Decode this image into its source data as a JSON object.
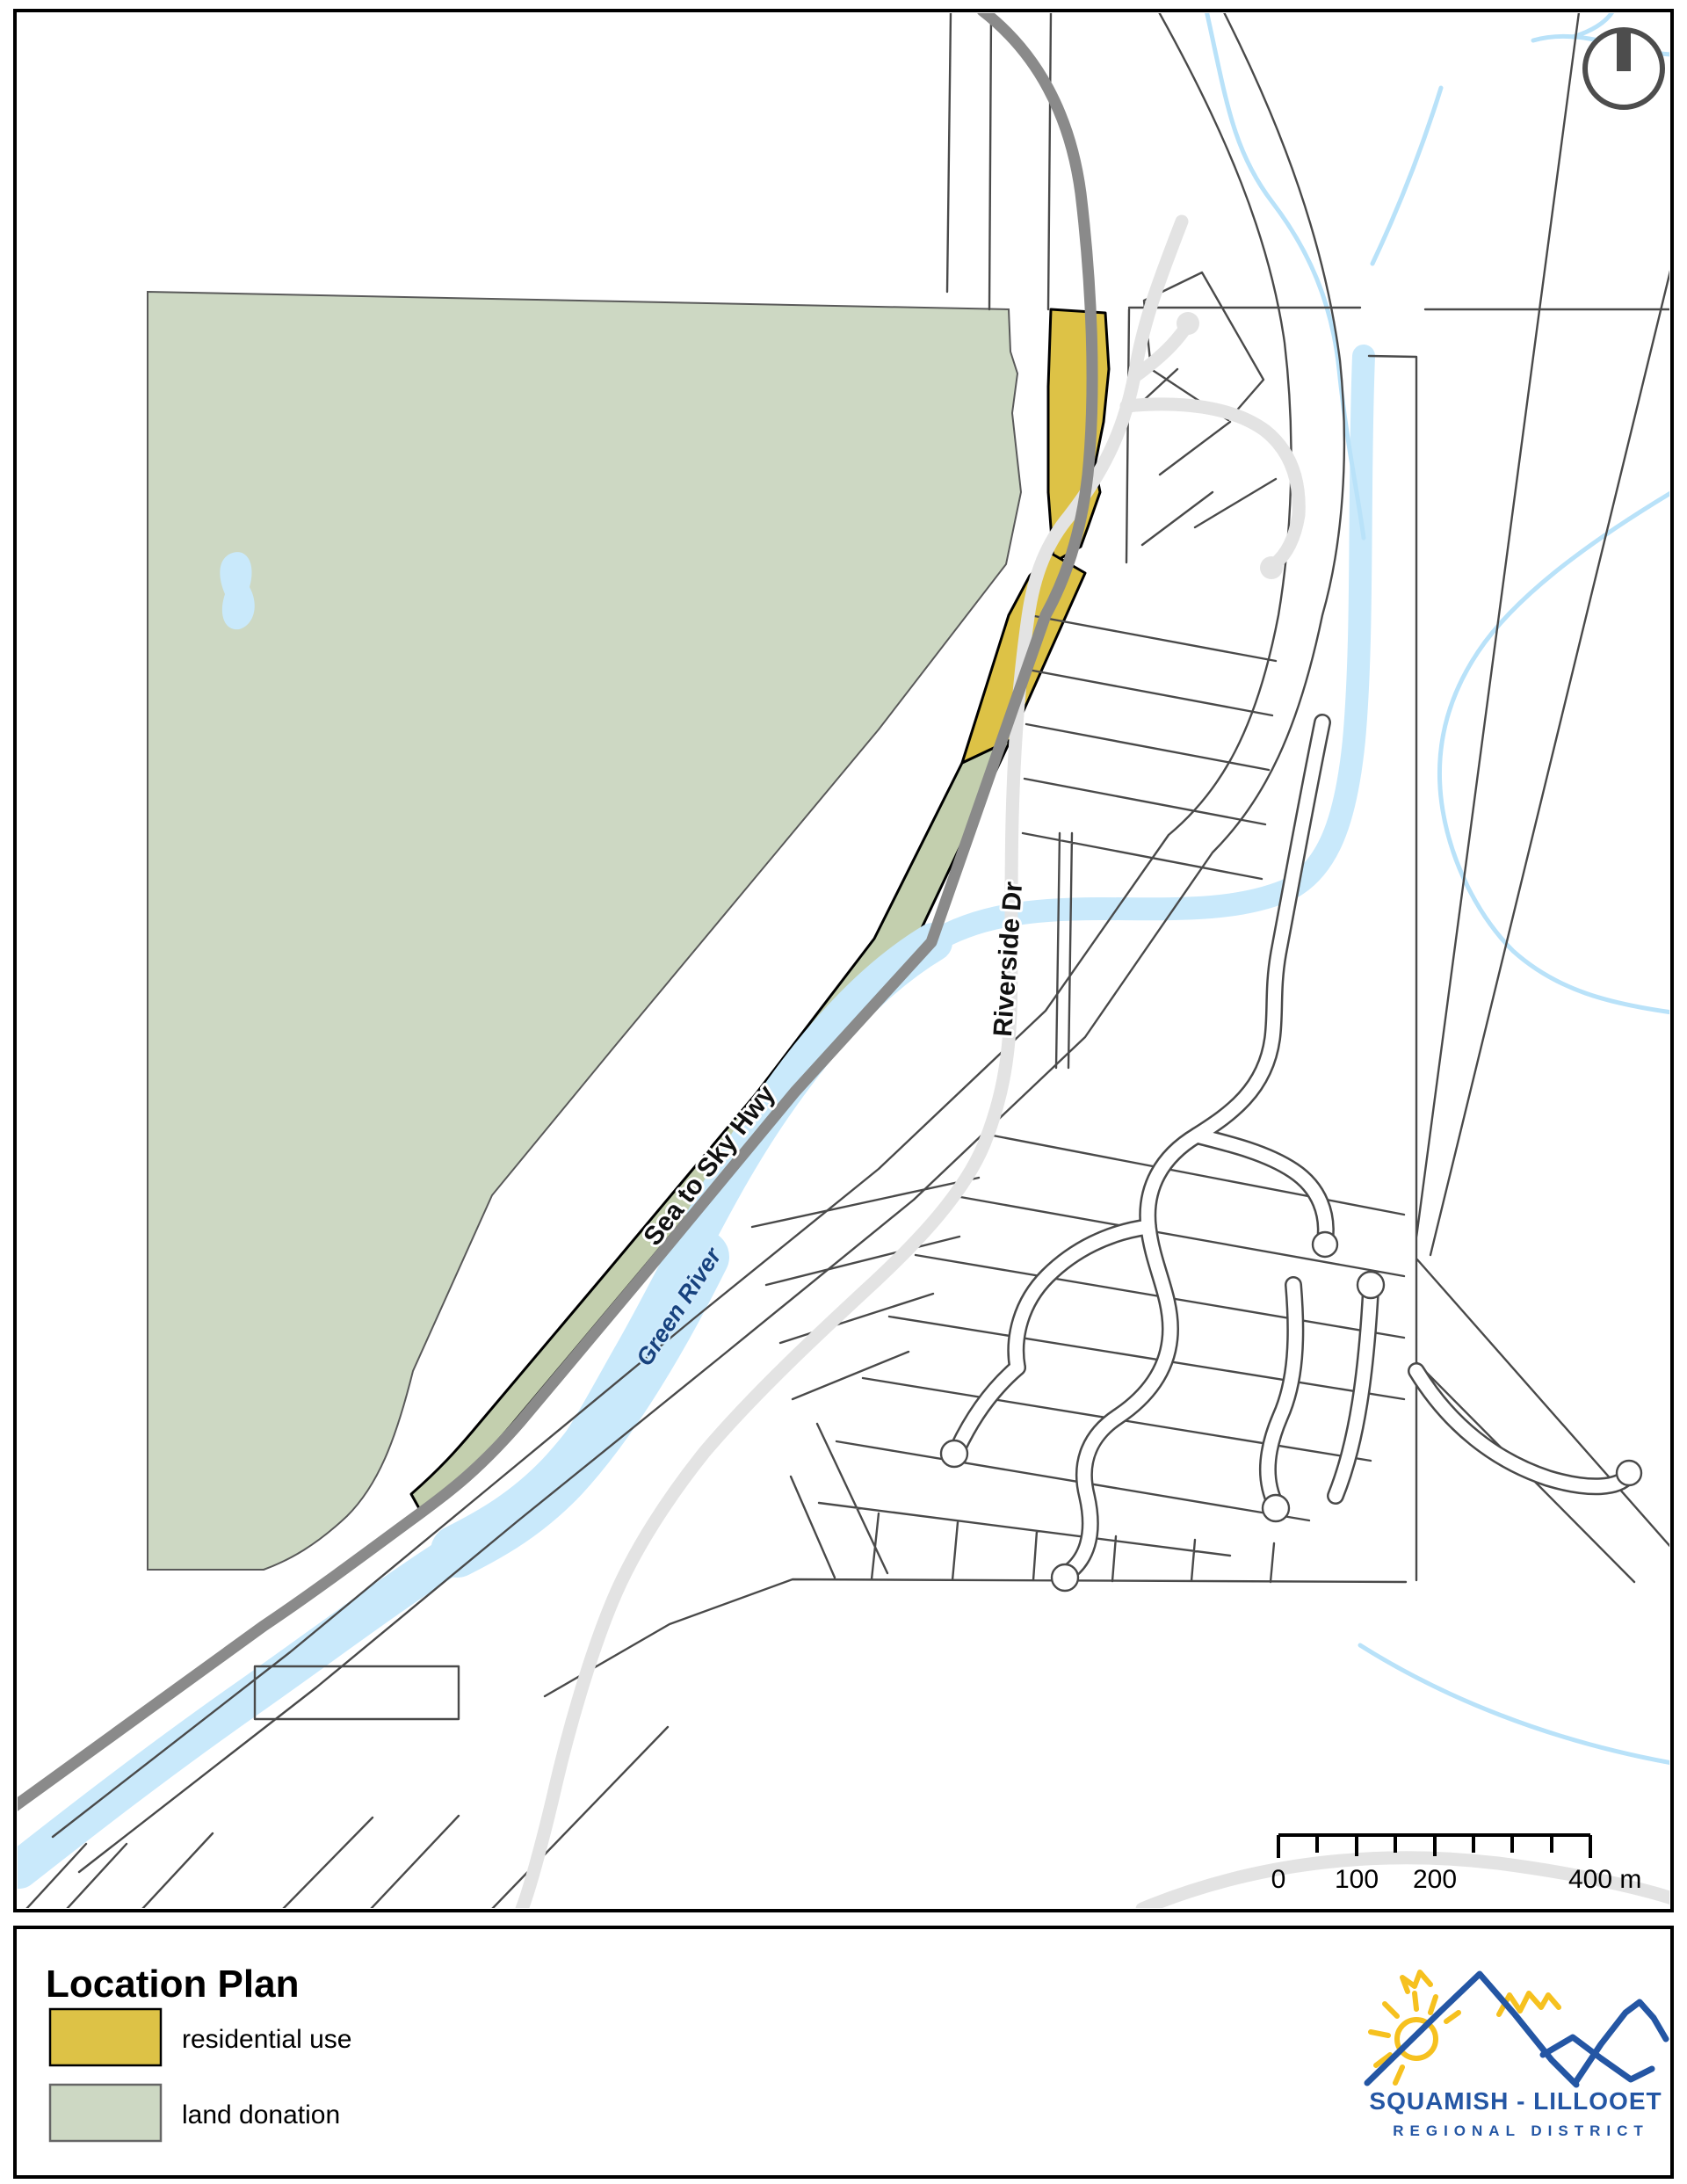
{
  "map": {
    "labels": {
      "highway": "Sea to Sky Hwy",
      "road": "Riverside Dr",
      "river": "Green River"
    },
    "scalebar": {
      "t0": "0",
      "t100": "100",
      "t200": "200",
      "t400": "400 m"
    }
  },
  "legend": {
    "title": "Location Plan",
    "items": [
      {
        "label": "residential use",
        "color": "#ddc246"
      },
      {
        "label": "land donation",
        "color": "#cdd8c3"
      }
    ]
  },
  "logo": {
    "line1": "SQUAMISH - LILLOOET",
    "line2": "REGIONAL DISTRICT",
    "blue": "#2456a4",
    "yellow": "#f6c11f"
  },
  "colors": {
    "residential": "#ddc246",
    "donation": "#cdd8c3",
    "donation_strip": "#c3cfae",
    "water": "#c9e9fb",
    "stream": "#b9e2f9",
    "highway": "#8a8a8a",
    "road": "#e3e3e3",
    "parcel": "#4a4a4a",
    "river_label": "#17427e",
    "frame": "#000000"
  }
}
